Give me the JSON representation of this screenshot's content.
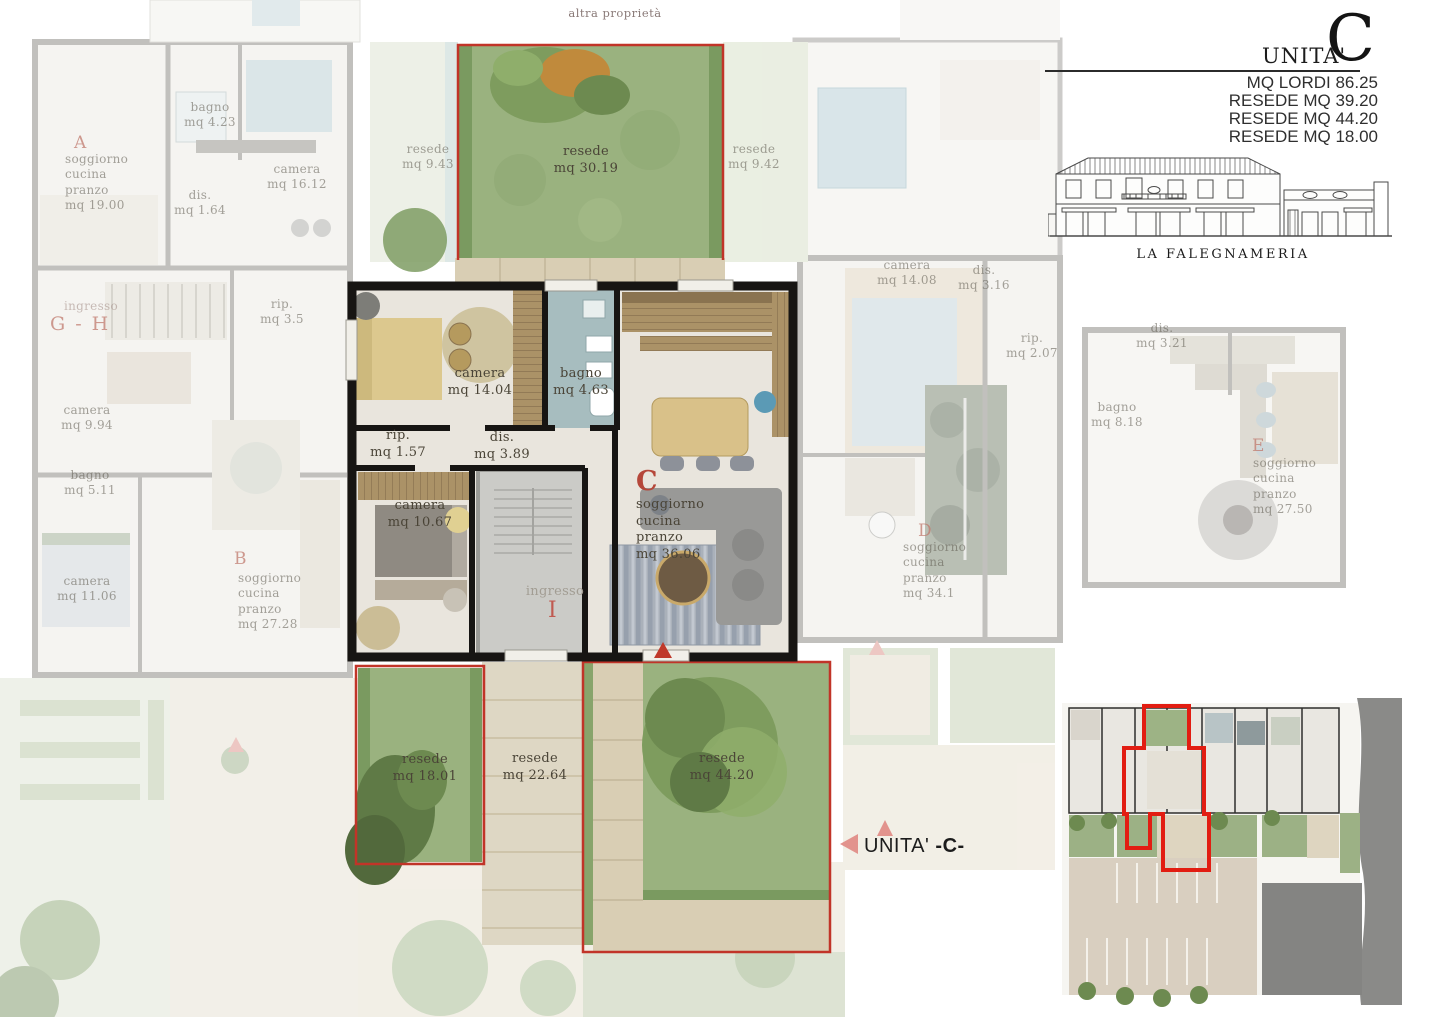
{
  "page": {
    "top_note": "altra proprietà"
  },
  "header": {
    "unit_label": "UNITA'",
    "unit_letter": "C",
    "stats": [
      "MQ LORDI 86.25",
      "RESEDE MQ 39.20",
      "RESEDE MQ 44.20",
      "RESEDE MQ 18.00"
    ],
    "elevation_caption": "LA FALEGNAMERIA"
  },
  "unit": {
    "letter": "C",
    "rooms": {
      "camera1": "camera\nmq 14.04",
      "bagno": "bagno\nmq 4.63",
      "rip": "rip.\nmq 1.57",
      "dis": "dis.\nmq 3.89",
      "camera2": "camera\nmq 10.67",
      "soggiorno": "soggiorno\ncucina\npranzo\nmq 36.06",
      "ingresso": "ingresso",
      "ingresso_letter": "I"
    },
    "gardens": {
      "top": "resede\nmq 30.19",
      "bottom_left": "resede\nmq 18.01",
      "bottom_mid": "resede\nmq 22.64",
      "bottom_right": "resede\nmq 44.20"
    },
    "callout_prefix": "UNITA'",
    "callout_letter": "-C-"
  },
  "context": {
    "apt_a_letter": "A",
    "apt_a_soggiorno": "soggiorno\ncucina\npranzo\nmq 19.00",
    "apt_a_bagno": "bagno\nmq 4.23",
    "apt_a_camera": "camera\nmq 16.12",
    "apt_a_dis": "dis.\nmq 1.64",
    "gh_ingresso": "ingresso",
    "gh_letters": "G - H",
    "gh_rip": "rip.\nmq 3.5",
    "gh_camera": "camera\nmq 9.94",
    "gh_bagno": "bagno\nmq 5.11",
    "apt_b_letter": "B",
    "apt_b_soggiorno": "soggiorno\ncucina\npranzo\nmq 27.28",
    "apt_b_camera": "camera\nmq 11.06",
    "resede_left": "resede\nmq 9.43",
    "resede_right": "resede\nmq 9.42",
    "apt_d_camera": "camera\nmq 14.08",
    "apt_d_dis": "dis.\nmq 3.16",
    "apt_d_rip": "rip.\nmq 2.07",
    "apt_d_letter": "D",
    "apt_d_soggiorno": "soggiorno\ncucina\npranzo\nmq 34.1",
    "apt_e_bagno": "bagno\nmq 8.18",
    "apt_e_dis": "dis.\nmq 3.21",
    "apt_e_letter": "E",
    "apt_e_soggiorno": "soggiorno\ncucina\npranzo\nmq 27.50"
  },
  "colors": {
    "red_outline": "#c13428",
    "accent_red": "#b5473a",
    "grass": "#9ab27f",
    "bagno_floor": "#a7bdbf",
    "travertine": "#d9ceb4"
  }
}
